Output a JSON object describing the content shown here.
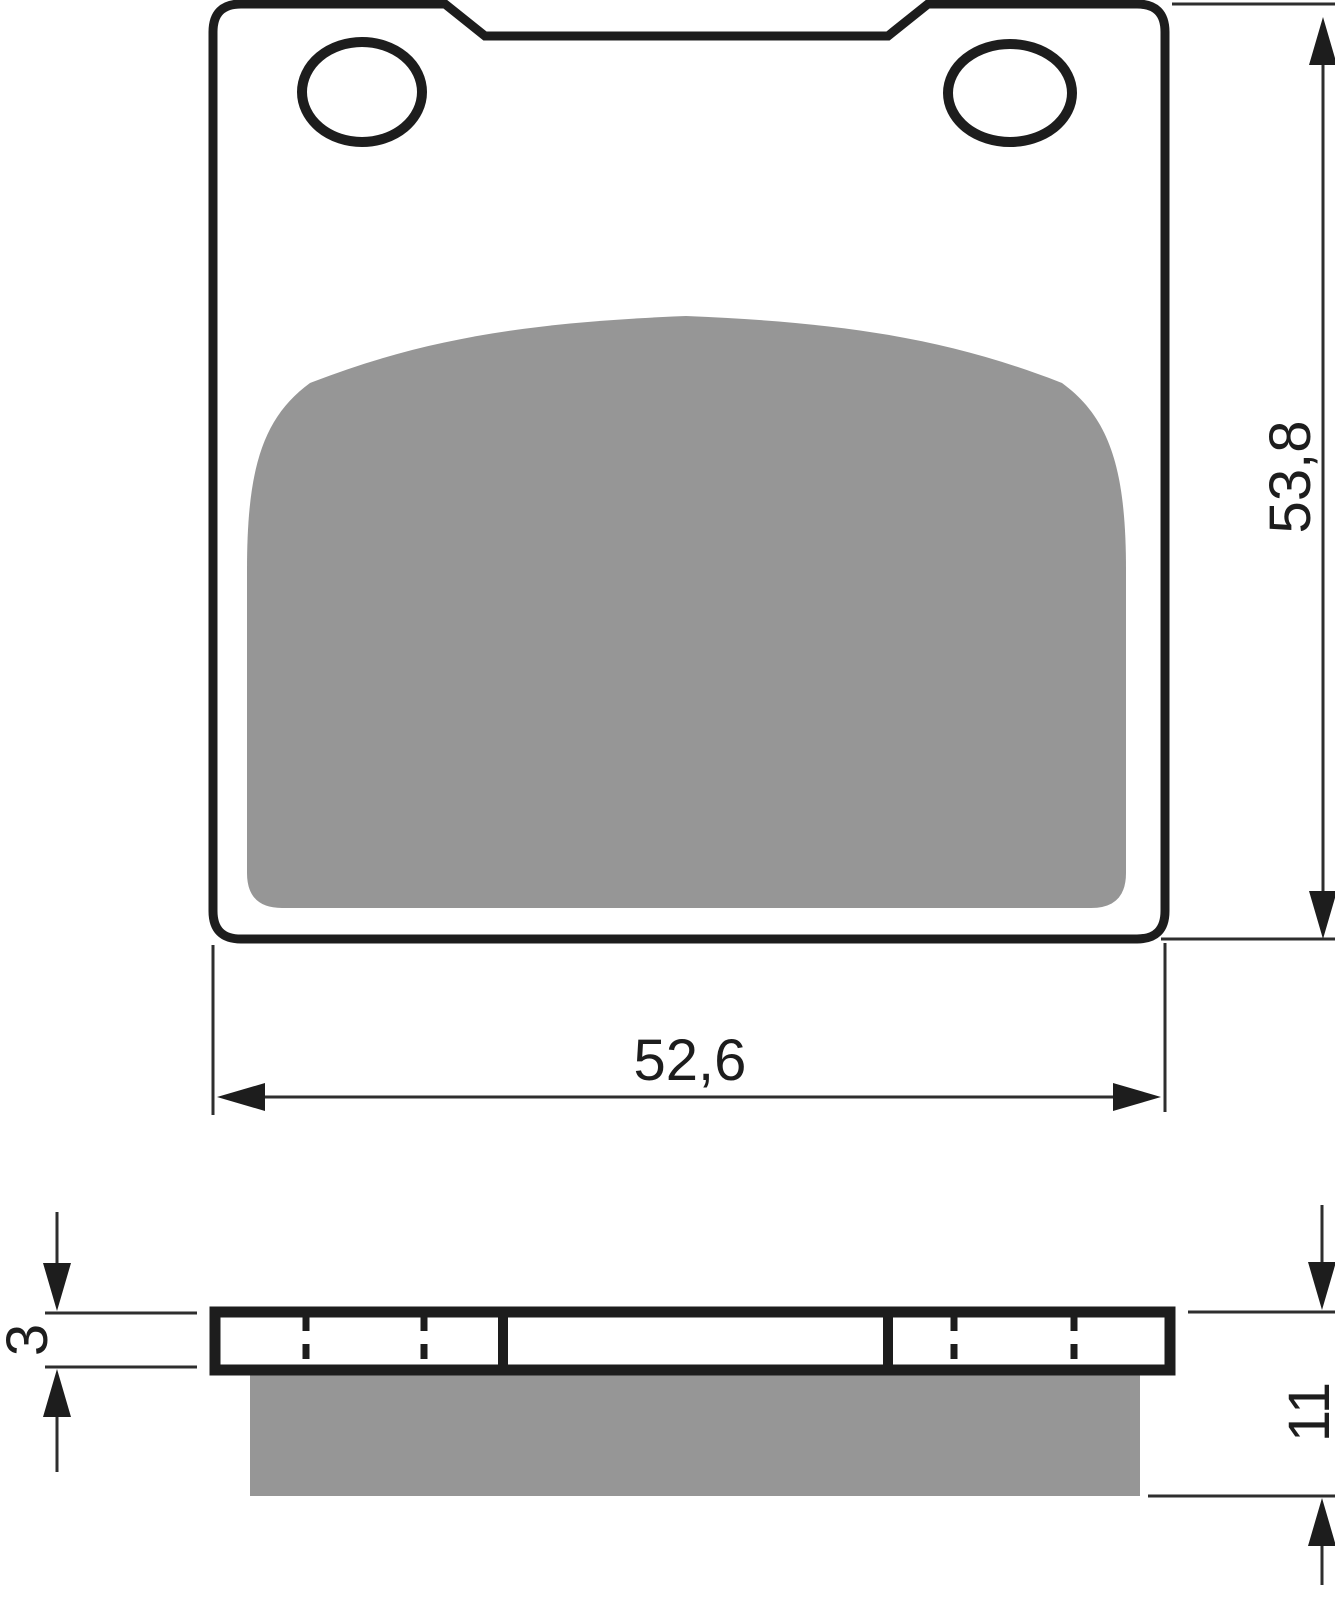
{
  "drawing": {
    "type": "technical-drawing",
    "subject": "brake-pad",
    "views": {
      "top_view": "pad backing plate with two mounting holes and friction material",
      "side_view": "backing plate cross-section with friction material below"
    }
  },
  "dimensions": {
    "width_label": "52,6",
    "height_label": "53,8",
    "plate_thickness_label": "3",
    "pad_thickness_label": "11"
  },
  "colors": {
    "outline": "#1d1d1d",
    "pad_gray": "#969696",
    "dim_line": "#2e2e2e",
    "background": "#ffffff"
  }
}
